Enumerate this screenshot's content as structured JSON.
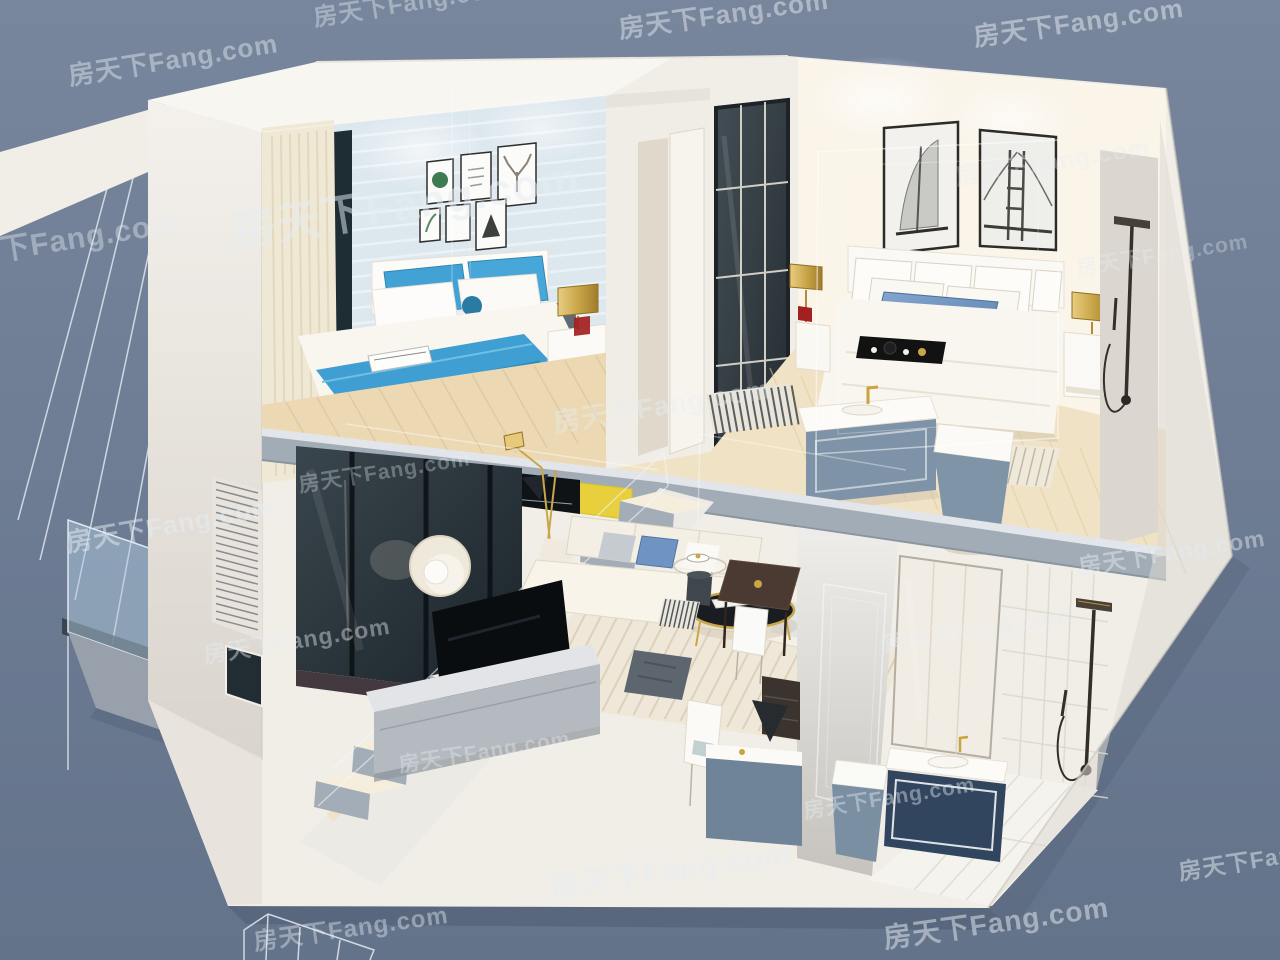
{
  "image": {
    "kind": "3D cutaway architectural render",
    "subject": "Two-storey loft apartment dollhouse section view",
    "background_color": "#6b7a90"
  },
  "watermark": {
    "text": "房天下Fang.com",
    "color": "#e7edf4",
    "opacity": 0.42
  },
  "palette": {
    "shell_white": "#f1eee8",
    "bedroom_wall_blue": "#dce7ee",
    "bedding_blue": "#3f9ed2",
    "denim_pillow_blue": "#6b92c2",
    "slab_gray": "#a2acb7",
    "smoked_glass": "#242e34",
    "brass_gold": "#c9a648",
    "wood_floor": "#ecd9b4",
    "cabinet_blue_gray": "#7e93a8",
    "vanity_navy": "#32455e",
    "art_yellow": "#e7d03c",
    "stair_tread": "#f6eedd",
    "stair_riser": "#a3adb8"
  },
  "structure": {
    "upper_floor": {
      "label": "upper floor",
      "rooms": [
        {
          "label": "bedroom with blue striped wallpaper",
          "items": [
            "gallery wall of six framed prints",
            "double bed with blue and white bedding",
            "blue accent pillows",
            "white nightstand",
            "brass drum table lamp with red glass",
            "cream curtains",
            "dark window slit",
            "wood plank floor"
          ]
        },
        {
          "label": "hallway",
          "items": [
            "white open door",
            "black framed glass door",
            "striped runner rug"
          ]
        },
        {
          "label": "white master bedroom",
          "items": [
            "sailboat artwork",
            "bridge artwork",
            "white bed with denim blue lumbar pillow",
            "black breakfast tray with tea set",
            "brass drum lamps",
            "white nightstands",
            "striped runner at bed foot",
            "white vanity with blue-gray cabinet",
            "blue-gray toilet",
            "dark shower column"
          ]
        }
      ]
    },
    "lower_floor": {
      "label": "lower floor",
      "rooms": [
        {
          "label": "double-height living room",
          "items": [
            "white staircase to loft",
            "glass balustrade",
            "smoked glass feature wall",
            "flat screen TV",
            "gray media cabinet",
            "cream sofa with blue cushion",
            "barrel armchair",
            "round black coffee table with brass rim",
            "striped area rug",
            "brass floor lamp",
            "dark pouf",
            "black sailboat artwork",
            "yellow artwork"
          ]
        },
        {
          "label": "dining and work corner",
          "items": [
            "glass side table",
            "dark drum stool",
            "dark wood dining table",
            "white chairs",
            "dark shelf unit",
            "white desk chair",
            "blue-gray counter"
          ]
        },
        {
          "label": "bathroom",
          "items": [
            "framed mirror",
            "navy vanity with white basin",
            "brass faucet",
            "blue-gray toilet",
            "dark shower column",
            "white tiled wall",
            "white tiled floor"
          ]
        }
      ]
    },
    "exterior": {
      "label": "exterior",
      "items": [
        "slate blue backdrop",
        "white wireframe building outline",
        "glass balcony with gray deck",
        "louvered vent on side wall",
        "dark window on pillar",
        "white roof slab",
        "ground shadow"
      ]
    }
  }
}
